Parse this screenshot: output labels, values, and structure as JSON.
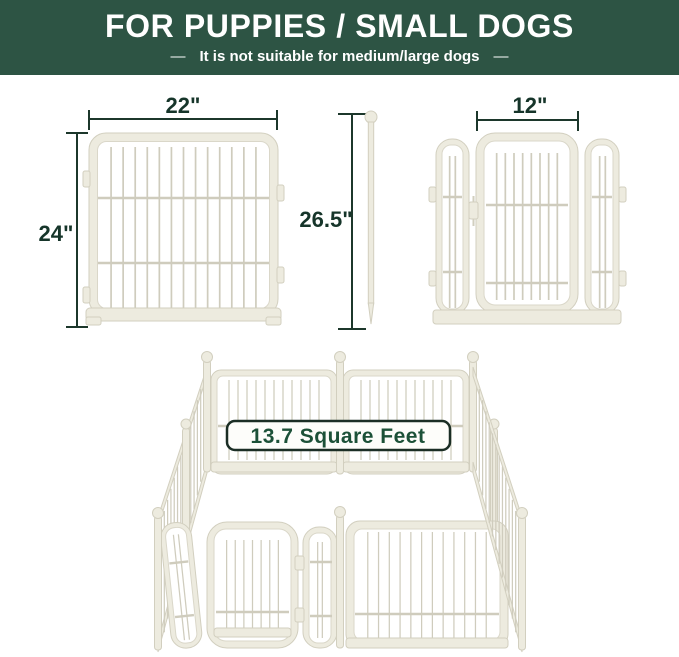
{
  "banner": {
    "title": "FOR PUPPIES / SMALL DOGS",
    "dash": "—",
    "subtitle": "It is not suitable for medium/large dogs",
    "bg_color": "#2d5444",
    "text_color": "#ffffff"
  },
  "diagrams": {
    "panel": {
      "width_label": "22\"",
      "height_label": "24\""
    },
    "stake": {
      "height_label": "26.5\""
    },
    "door": {
      "width_label": "12\""
    },
    "playpen": {
      "area_label": "13.7 Square Feet"
    },
    "colors": {
      "dimension_line": "#1c372b",
      "dimension_text": "#16352a",
      "fence_fill": "#edebdf",
      "fence_outline": "#d2cfbf",
      "badge_bg": "#fdfdfa",
      "badge_border": "#1b2e25",
      "badge_text": "#1c5138"
    }
  }
}
